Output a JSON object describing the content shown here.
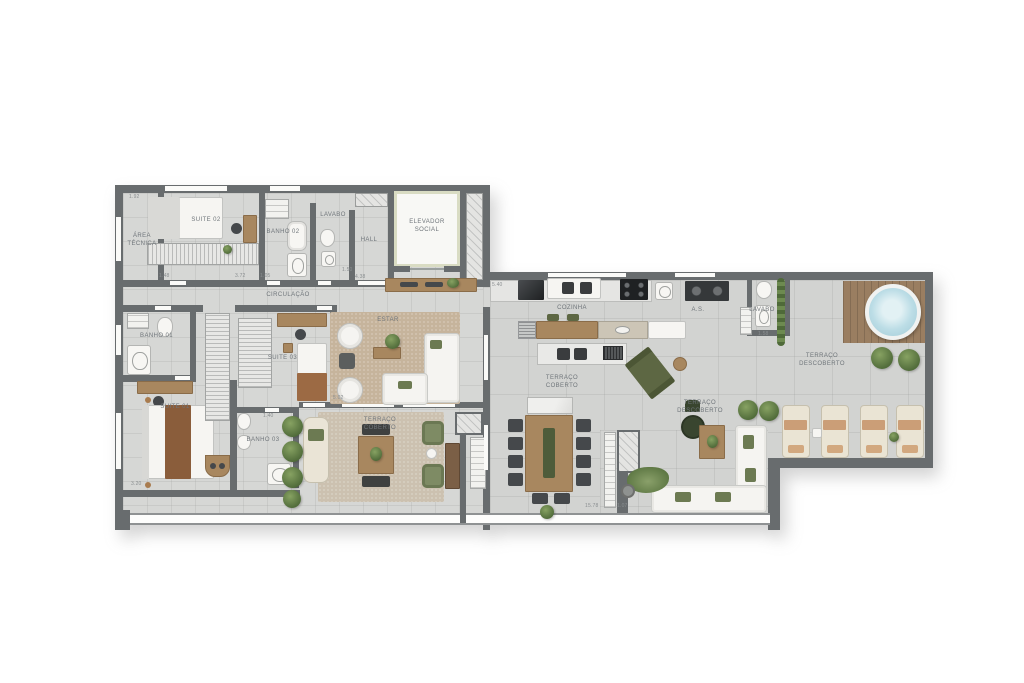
{
  "rooms": {
    "area_tecnica": "ÁREA\nTÉCNICA",
    "suite_02": "SUITE 02",
    "banho_02": "BANHO 02",
    "lavabo": "LAVABO",
    "hall": "HALL",
    "elevador_social": "ELEVADOR\nSOCIAL",
    "circulacao": "CIRCULAÇÃO",
    "banho_01": "BANHO 01",
    "suite_01": "SUITE 01",
    "suite_03": "SUITE 03",
    "banho_03": "BANHO 03",
    "estar": "ESTAR",
    "cozinha": "COZINHA",
    "as": "A.S.",
    "lavabo_2": "LAVABO",
    "terraco_coberto": "TERRAÇO\nCOBERTO",
    "terraco_descoberto": "TERRAÇO\nDESCOBERTO"
  },
  "dims": [
    "1.92",
    "1.48",
    "3.72",
    "1.05",
    "1.50",
    "4.38",
    "5.40",
    "1.40",
    "3.20",
    "5.02",
    "15.78",
    "1.07",
    "1.58"
  ],
  "palette": {
    "wall": "#686c6e",
    "floor": "#d6d7d5",
    "rug": "#c6b49c",
    "wood": "#a8875f",
    "plant_green": "#5f7a47",
    "olive_chair": "#5d6743",
    "jacuzzi_water": "#aed4de",
    "lounger_stripe": "#cb9e77",
    "elevator_frame": "#d9dcc3"
  }
}
